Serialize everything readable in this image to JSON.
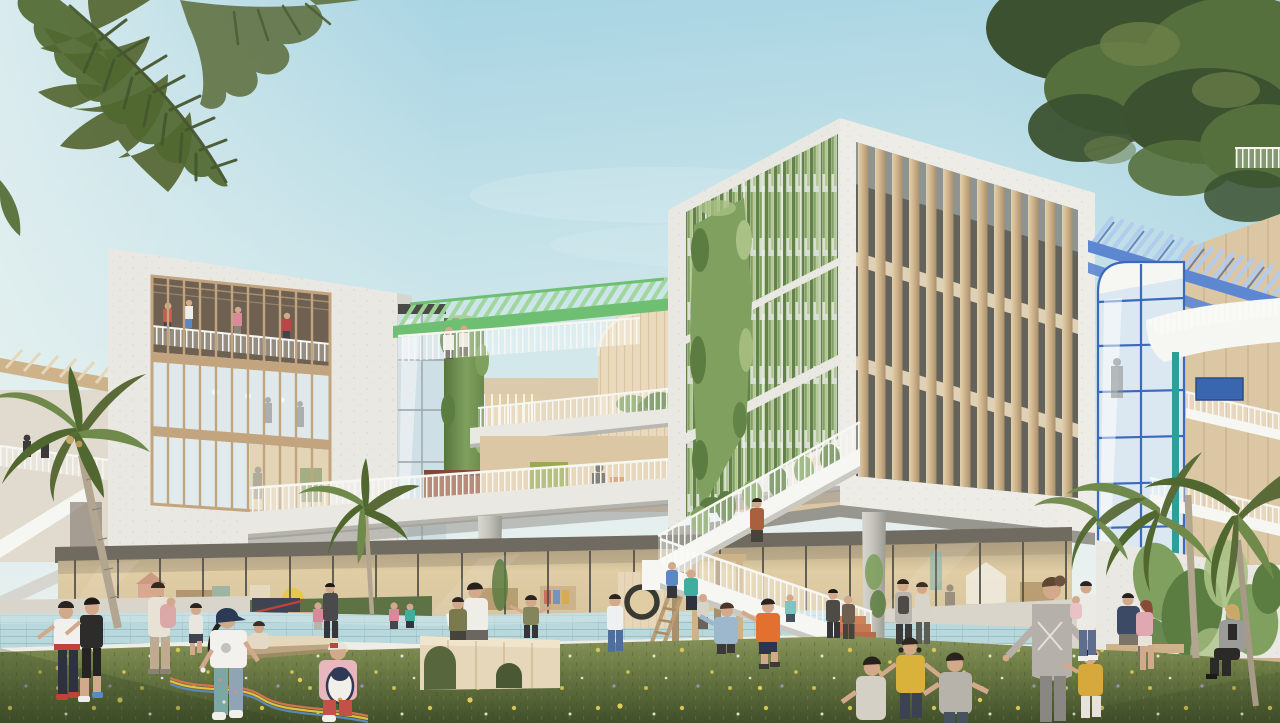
{
  "scene": {
    "description": "Daylight architectural rendering of a modern kindergarten campus: two white box buildings with wooden mullions and hanging ivy facades, stepped terraces with green and blue pergolas, a glass ground floor, a long reflecting pool, and children and adults playing on a flowered lawn framed by palm trees.",
    "elements": [
      "sky",
      "palm-fronds-overlay",
      "tree-canopy",
      "left-background-building",
      "left-building",
      "central-terraces",
      "green-pergola",
      "glass-elevator",
      "green-living-wall",
      "timber-cylinder-volume",
      "right-building",
      "timber-slat-facade",
      "ivy-curtain-facade",
      "blue-pergola",
      "blue-glass-elevator",
      "white-staircase",
      "terracotta-steps",
      "climbing-frame",
      "porthole-play-wall",
      "ground-floor-glazing",
      "reflecting-pool",
      "lawn",
      "wooden-play-bench",
      "ivy-wall",
      "palm-trees",
      "children",
      "adults"
    ]
  },
  "palette": {
    "skyTop": "#9fcfe0",
    "skyMid": "#c6e3e9",
    "skyHorizon": "#edf3f0",
    "concrete": "#e9e8e2",
    "concreteShade": "#d6d5cf",
    "concreteDark": "#8a887f",
    "soffitShadow": "#97968f",
    "woodFrame": "#c2a57f",
    "woodLight": "#e6d7ba",
    "woodMid": "#cdb28a",
    "woodDark": "#a9906c",
    "woodWall": "#dcc7a4",
    "cylinderWood": "#ead9bd",
    "glassCool": "#dfe9eb",
    "glassSky": "#cfdfe6",
    "glassWarm": "#e0cda4",
    "glassDark": "#5f6058",
    "interiorWarm": "#d9c7a0",
    "interiorDark": "#6e6152",
    "ivy": "#7fa05e",
    "ivyLight": "#a9c184",
    "ivyDark": "#5c7d42",
    "mintPergola": "#9fd79b",
    "mintDark": "#6fbf72",
    "bluePergola": "#5d87d1",
    "bluePergolaLight": "#b3cbed",
    "bluePergolaDark": "#3f66ab",
    "elevatorFrame": "#3a69bd",
    "teal": "#2e9e98",
    "railWhite": "#f6f6f3",
    "water": "#b9d8dc",
    "waterDark": "#94bcc3",
    "poolRim": "#efede5",
    "pavement": "#d9d5ca",
    "deckTurf": "#5d7345",
    "grassLight": "#879455",
    "grass": "#6e7d46",
    "grassDark": "#46552f",
    "flowerYellow": "#e3cd55",
    "flowerPurple": "#a394c8",
    "terracotta": "#c37954",
    "treeDark": "#3b5130",
    "treeMid": "#55703c",
    "palmGreen": "#6f8a4a",
    "palmDark": "#50682f",
    "palmOlive": "#5a6b38",
    "trunk": "#b3a691",
    "skin": "#d3a98c",
    "rust": "#9a5f48"
  },
  "people": [
    {
      "id": "child-white-shirt-red-belt",
      "primary_color": "#f2f0ec"
    },
    {
      "id": "child-black-outfit",
      "primary_color": "#2e2c2a"
    },
    {
      "id": "adult-carrying-child",
      "primary_color": "#e8e2d6"
    },
    {
      "id": "child-runner",
      "primary_color": "#e9e6df"
    },
    {
      "id": "girl-cap-rainbow-ribbon",
      "primary_color": "#f3f1ed"
    },
    {
      "id": "toddler-sitting",
      "primary_color": "#e3d9c4"
    },
    {
      "id": "girl-penguin-backpack",
      "primary_color": "#e8b7bd"
    },
    {
      "id": "man-dark-suit",
      "primary_color": "#4a4a4c"
    },
    {
      "id": "boy-white-blue",
      "primary_color": "#eef0f2"
    },
    {
      "id": "child-ladder-teal",
      "primary_color": "#3fae9f"
    },
    {
      "id": "child-ladder-blue",
      "primary_color": "#5b87c5"
    },
    {
      "id": "boy-denim-jacket",
      "primary_color": "#9db8cc"
    },
    {
      "id": "boy-orange-shirt",
      "primary_color": "#e2702e"
    },
    {
      "id": "teens-by-stairs",
      "primary_color": "#4e4a46"
    },
    {
      "id": "walker-hoodie",
      "primary_color": "#b9b4ac"
    },
    {
      "id": "girl-yellow-vest",
      "primary_color": "#d9b23c"
    },
    {
      "id": "boy-gray-shirt",
      "primary_color": "#b7b2aa"
    },
    {
      "id": "teacher-gray-cardigan",
      "primary_color": "#b5b0a9"
    },
    {
      "id": "toddler-mustard",
      "primary_color": "#d7a93c"
    },
    {
      "id": "man-holding-baby",
      "primary_color": "#eceae4"
    },
    {
      "id": "bench-man-navy",
      "primary_color": "#3c4a66"
    },
    {
      "id": "bench-girl-pink",
      "primary_color": "#e0a8b0"
    },
    {
      "id": "woman-gray-blazer",
      "primary_color": "#9b9b98"
    },
    {
      "id": "man-on-stairs-rust",
      "primary_color": "#a8603f"
    },
    {
      "id": "bench-reader-white",
      "primary_color": "#efede8"
    },
    {
      "id": "bench-kid-olive",
      "primary_color": "#7a7a4e"
    },
    {
      "id": "boy-pointing-olive",
      "primary_color": "#85855c"
    }
  ]
}
